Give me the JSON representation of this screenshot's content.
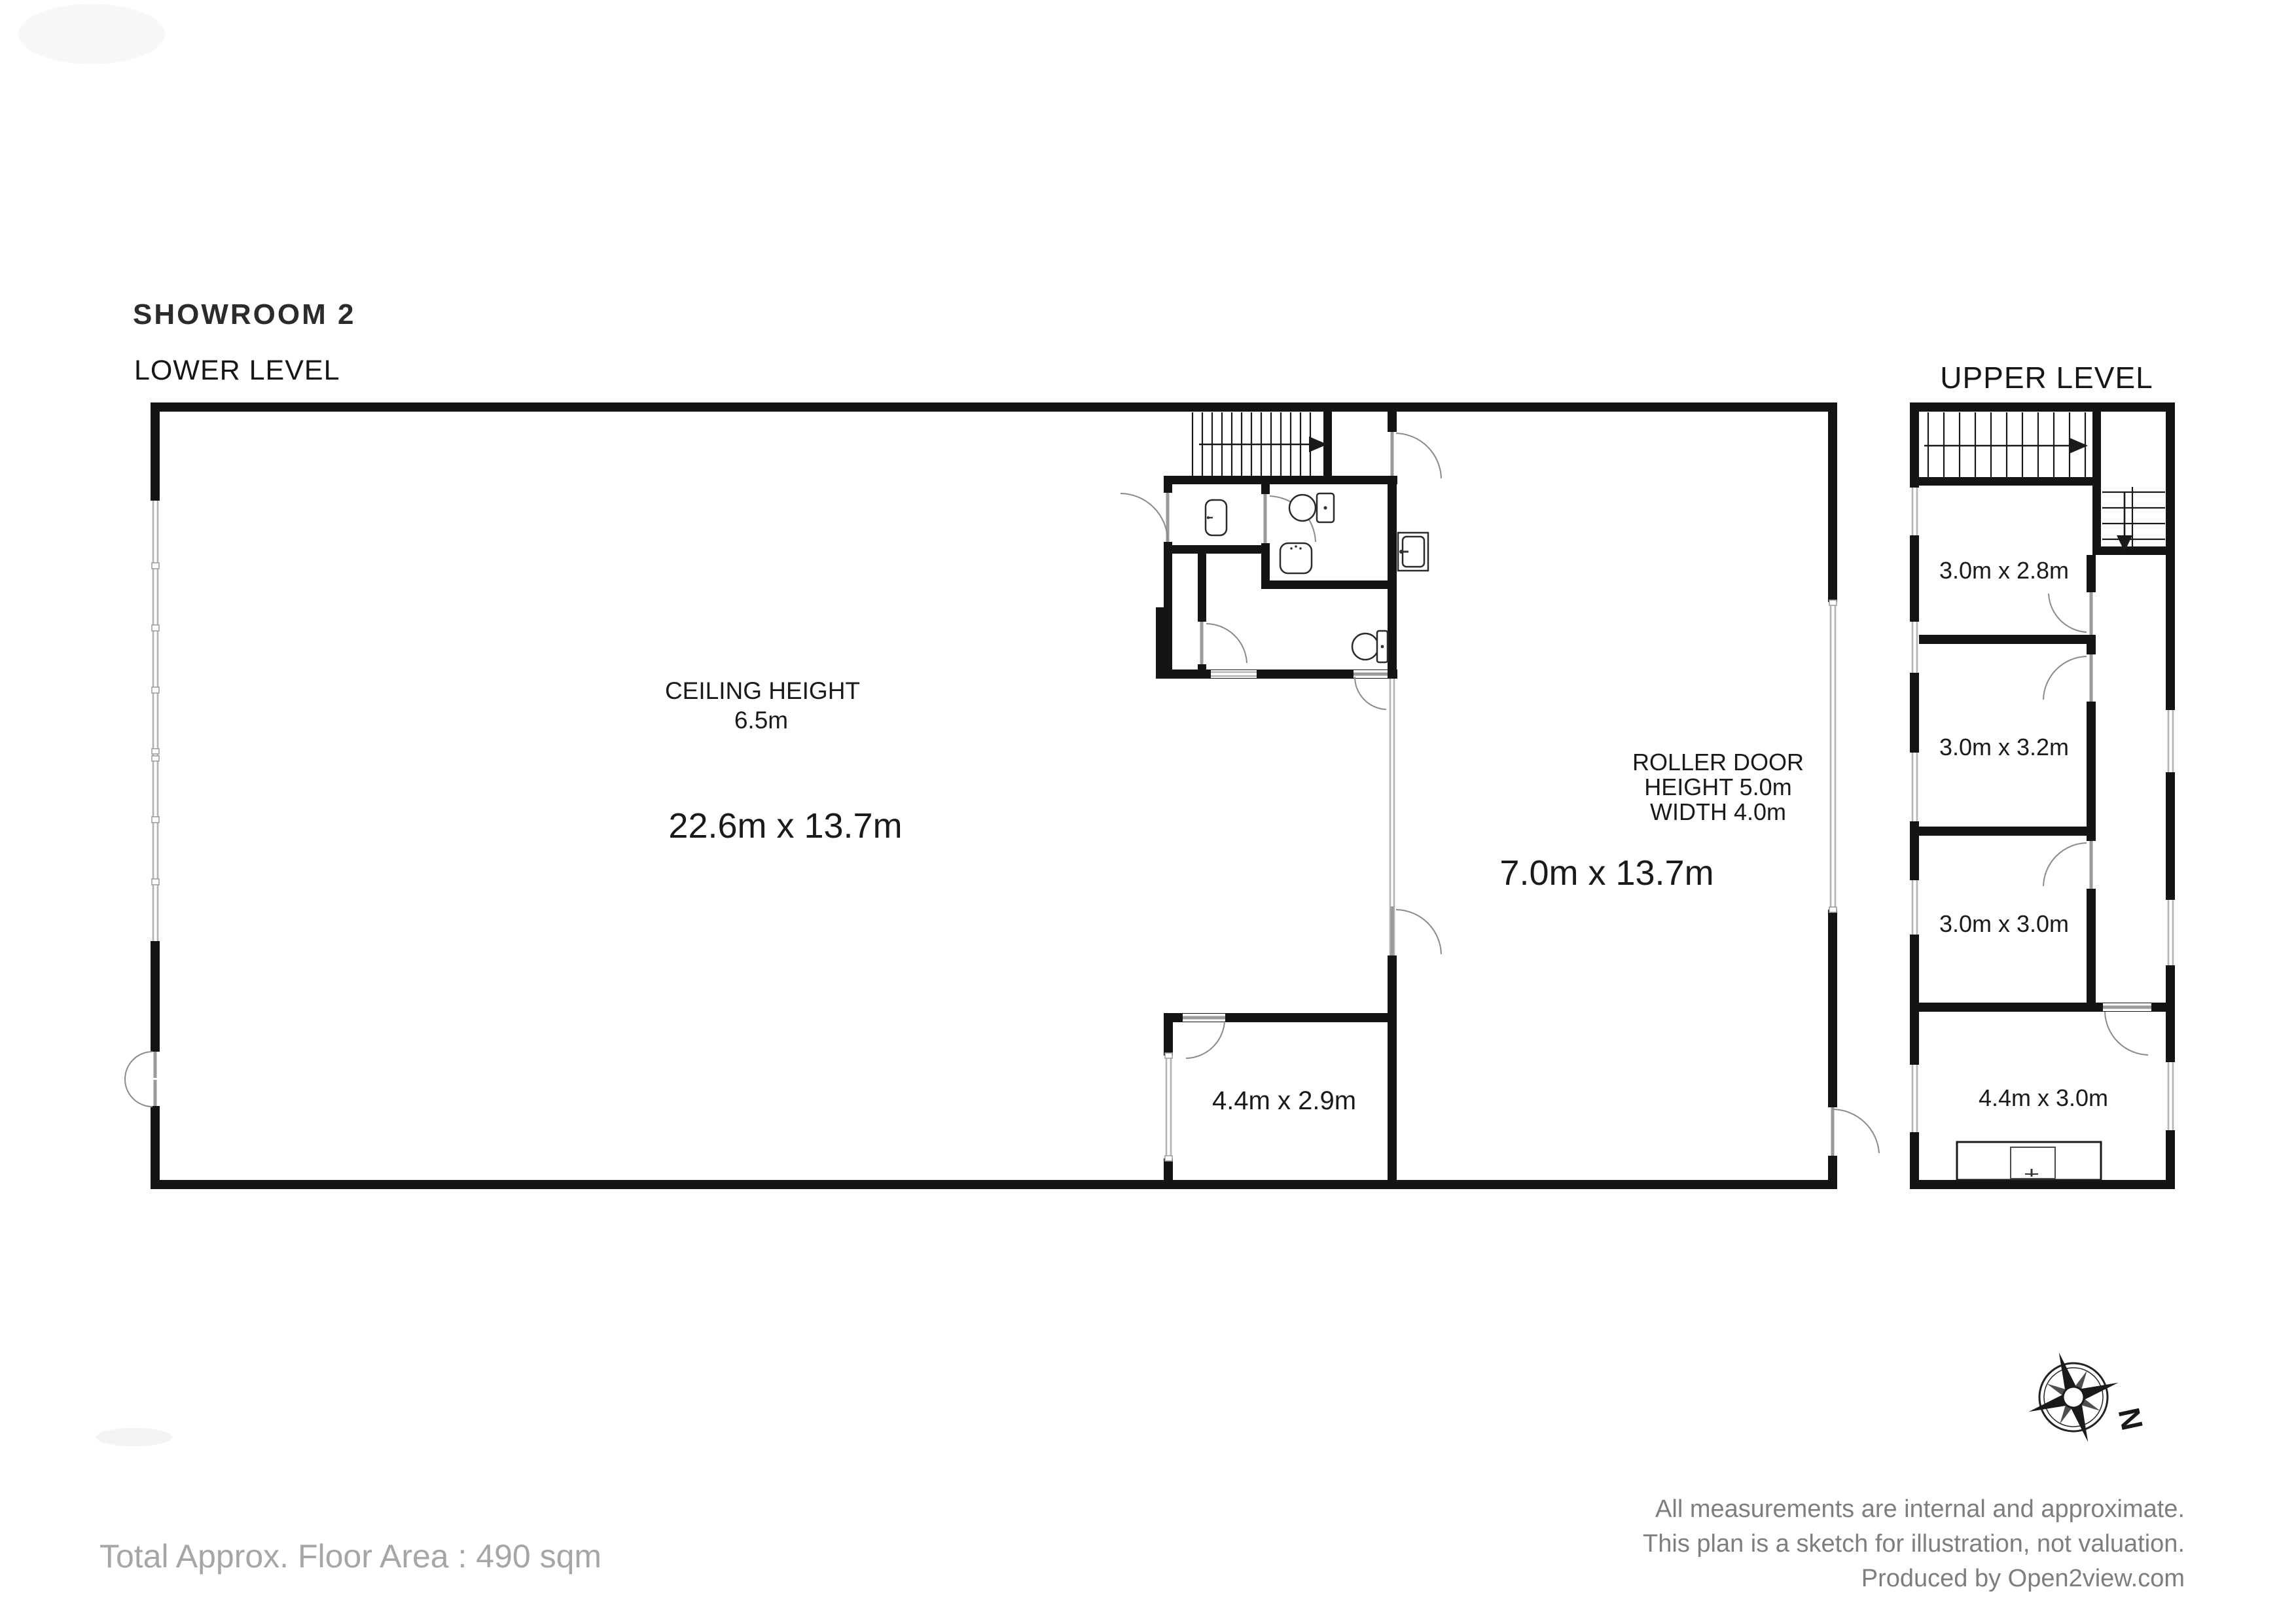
{
  "title": "SHOWROOM 2",
  "lower_level": {
    "label": "LOWER LEVEL",
    "showroom": {
      "ceiling_line1": "CEILING HEIGHT",
      "ceiling_line2": "6.5m",
      "dimensions": "22.6m x 13.7m"
    },
    "bay": {
      "roller_line1": "ROLLER DOOR",
      "roller_line2": "HEIGHT 5.0m",
      "roller_line3": "WIDTH 4.0m",
      "dimensions": "7.0m x 13.7m"
    },
    "store_room": {
      "dimensions": "4.4m x 2.9m"
    }
  },
  "upper_level": {
    "label": "UPPER LEVEL",
    "rooms": [
      {
        "dimensions": "3.0m x 2.8m"
      },
      {
        "dimensions": "3.0m x 3.2m"
      },
      {
        "dimensions": "3.0m x 3.0m"
      },
      {
        "dimensions": "4.4m x 3.0m"
      }
    ]
  },
  "compass": {
    "north_label": "N"
  },
  "footer": {
    "total_area": "Total Approx. Floor Area : 490 sqm",
    "disclaimer_line1": "All measurements are internal and approximate.",
    "disclaimer_line2": "This plan is a sketch for illustration, not valuation.",
    "disclaimer_line3": "Produced by Open2view.com"
  },
  "colors": {
    "wall": "#141414",
    "glazing": "#b4b4b4",
    "door": "#9a9a9a",
    "muted_text": "#a6a6a6",
    "disclaimer_text": "#7e7e7e"
  }
}
